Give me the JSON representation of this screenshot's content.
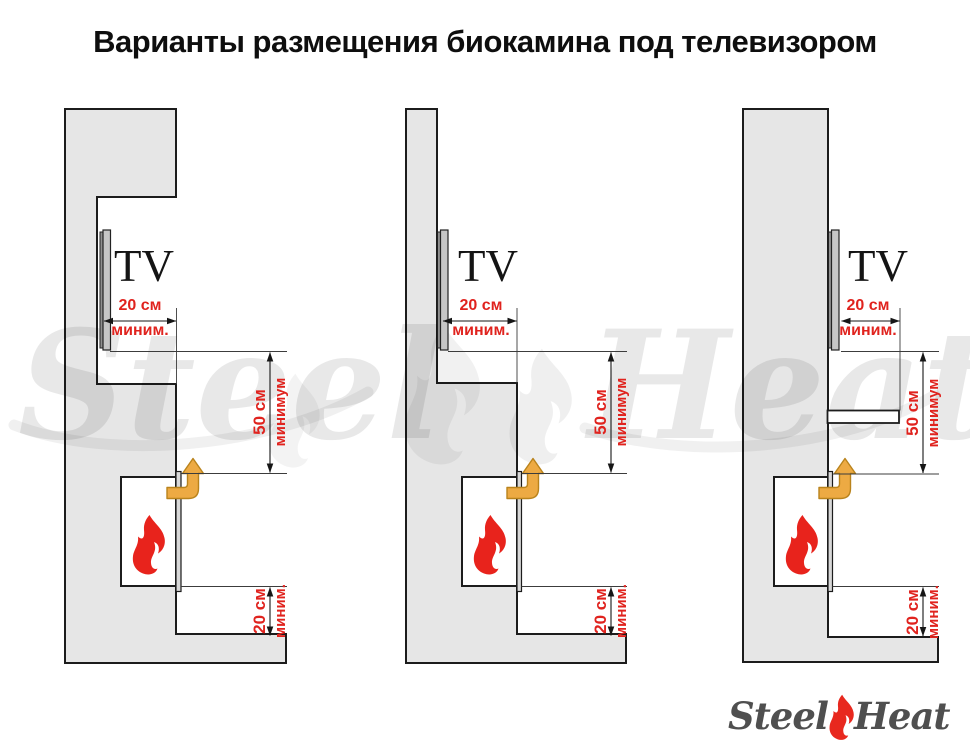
{
  "title": "Варианты размещения биокамина под телевизором",
  "colors": {
    "wall_fill": "#e6e6e6",
    "outline": "#1c1c1c",
    "dimension_red": "#e0231e",
    "flame_red": "#e8231c",
    "airflow_arrow_fill": "#edaa43",
    "airflow_arrow_stroke": "#b9831c",
    "tv_front": "#c6c6c6",
    "tv_back": "#8f8f8f",
    "logo_text": "#4f4f4f"
  },
  "diagrams": [
    {
      "labels": {
        "tv": "TV",
        "front_value": "20 см",
        "front_unit": "миним.",
        "vertical_value": "50 см",
        "vertical_unit": "минимум",
        "bottom_value": "20 см",
        "bottom_unit": "миним."
      }
    },
    {
      "labels": {
        "tv": "TV",
        "front_value": "20 см",
        "front_unit": "миним.",
        "vertical_value": "50 см",
        "vertical_unit": "минимум",
        "bottom_value": "20 см",
        "bottom_unit": "миним."
      }
    },
    {
      "labels": {
        "tv": "TV",
        "front_value": "20 см",
        "front_unit": "миним.",
        "vertical_value": "50 см",
        "vertical_unit": "минимум",
        "bottom_value": "20 см",
        "bottom_unit": "миним."
      }
    }
  ],
  "watermark": {
    "left_word": "Steel",
    "right_word": "Heat"
  },
  "logo": {
    "left_word": "Steel",
    "right_word": "Heat"
  }
}
